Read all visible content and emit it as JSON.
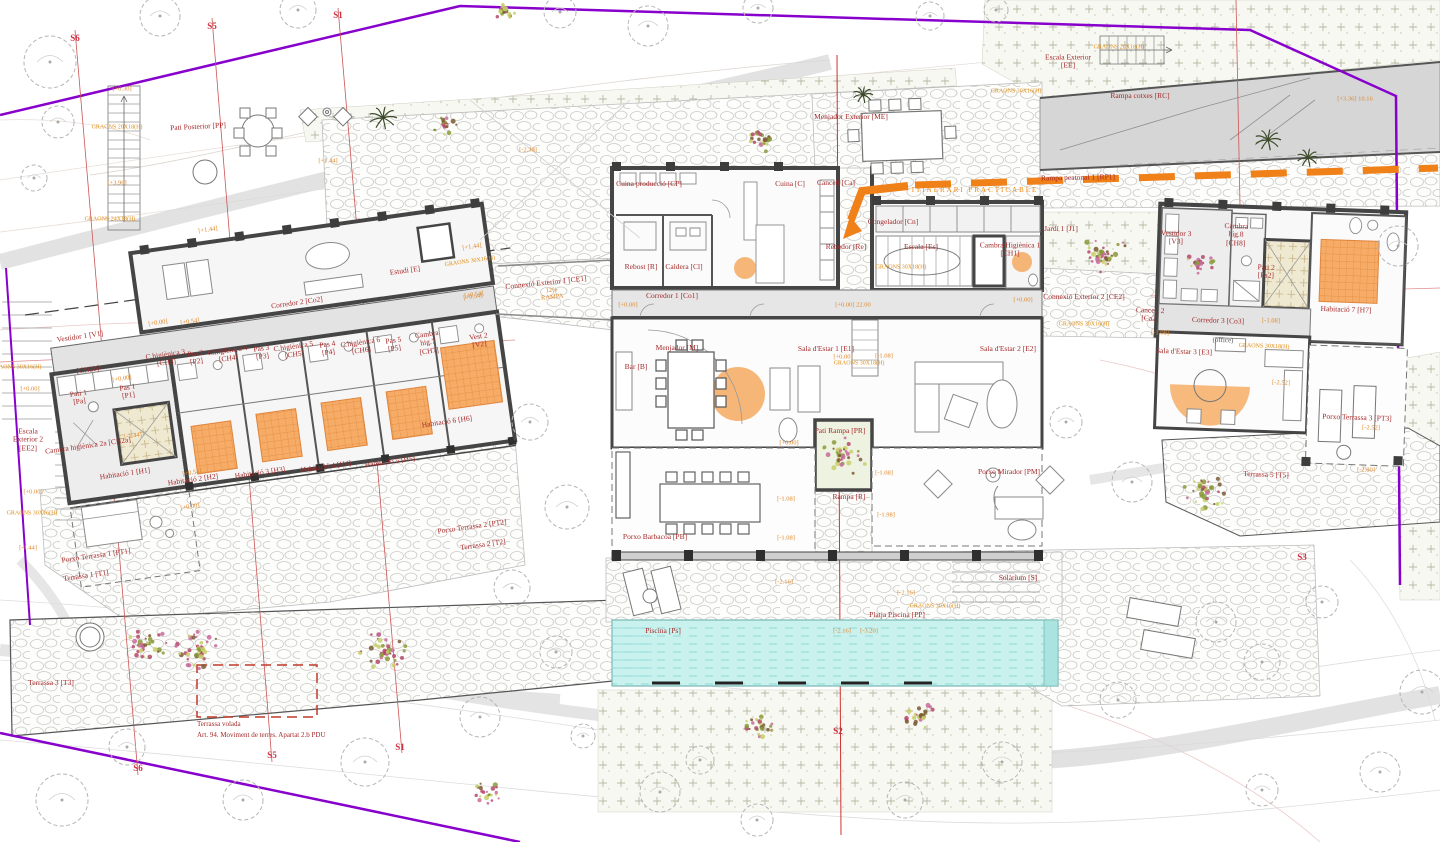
{
  "meta": {
    "title": "Planta distribució — habitatge unifamiliar (site plan)",
    "language": "ca"
  },
  "colors": {
    "room_label": "#a52a2a",
    "elevation_label": "#e0882a",
    "section_label": "#cf3344",
    "boundary_purple": "#8800cc",
    "driveway_orange": "#f08018",
    "bed_highlight": "#f5a95f",
    "pool_cyan": "#c9f2ef",
    "wall": "#454545"
  },
  "labels": [
    {
      "id": "vestidor-1",
      "t": "Vestidor 1 [V1]",
      "x": 80,
      "y": 337,
      "c": "room",
      "r": -8
    },
    {
      "id": "ch2b",
      "t": "[CH2b]",
      "x": 88,
      "y": 370,
      "c": "room",
      "r": -8
    },
    {
      "id": "pati-1",
      "t": "Pati 1\n[Pa]",
      "x": 79,
      "y": 398,
      "c": "room",
      "r": -8
    },
    {
      "id": "pas-1",
      "t": "Pas 1\n[P1]",
      "x": 128,
      "y": 392,
      "c": "room",
      "r": -8
    },
    {
      "id": "ch2a",
      "t": "Cambra higiènica 2a [CH2a]",
      "x": 88,
      "y": 446,
      "c": "room",
      "r": -8
    },
    {
      "id": "h1",
      "t": "Habitació 1 [H1]",
      "x": 125,
      "y": 474,
      "c": "room",
      "r": -8
    },
    {
      "id": "h2",
      "t": "Habitació 2 [H2]",
      "x": 193,
      "y": 480,
      "c": "room",
      "r": -8
    },
    {
      "id": "h3",
      "t": "Habitació 3 [H3]",
      "x": 260,
      "y": 473,
      "c": "room",
      "r": -8
    },
    {
      "id": "h4",
      "t": "Habitació 4 [H4]",
      "x": 326,
      "y": 467,
      "c": "room",
      "r": -8
    },
    {
      "id": "h5",
      "t": "Habitació 5 [H5]",
      "x": 390,
      "y": 462,
      "c": "room",
      "r": -8
    },
    {
      "id": "h6",
      "t": "Habitació 6 [H6]",
      "x": 447,
      "y": 422,
      "c": "room",
      "r": -8
    },
    {
      "id": "ch3",
      "t": "C.higiènica 3\n[CH3]",
      "x": 166,
      "y": 359,
      "c": "room",
      "r": -8
    },
    {
      "id": "pas-2",
      "t": "Pas 2\n[P2]",
      "x": 196,
      "y": 358,
      "c": "room",
      "r": -8
    },
    {
      "id": "ch4",
      "t": "C.higiènica 4\n[CH4]",
      "x": 228,
      "y": 355,
      "c": "room",
      "r": -8
    },
    {
      "id": "pas-3",
      "t": "Pas 3\n[P3]",
      "x": 262,
      "y": 353,
      "c": "room",
      "r": -8
    },
    {
      "id": "ch5",
      "t": "C.higiènica 5\n[CH5]",
      "x": 294,
      "y": 351,
      "c": "room",
      "r": -8
    },
    {
      "id": "pas-4",
      "t": "Pas 4\n[P4]",
      "x": 328,
      "y": 349,
      "c": "room",
      "r": -8
    },
    {
      "id": "ch6",
      "t": "C.higiènica 6\n[CH6]",
      "x": 361,
      "y": 347,
      "c": "room",
      "r": -8
    },
    {
      "id": "pas-5",
      "t": "Pas 5\n[P5]",
      "x": 394,
      "y": 345,
      "c": "room",
      "r": -8
    },
    {
      "id": "ch7",
      "t": "Cambra\nhig.7\n[CH7]",
      "x": 428,
      "y": 343,
      "c": "room",
      "r": -8
    },
    {
      "id": "vest-2",
      "t": "Vest 2\n[V2]",
      "x": 479,
      "y": 341,
      "c": "room",
      "r": -8
    },
    {
      "id": "corredor-2",
      "t": "Corredor 2 [Co2]",
      "x": 297,
      "y": 303,
      "c": "room",
      "r": -8
    },
    {
      "id": "estudi",
      "t": "Estudi [E]",
      "x": 405,
      "y": 271,
      "c": "room",
      "r": -8
    },
    {
      "id": "porxo-terrassa-1",
      "t": "Porxo Terrassa 1 [PT1]",
      "x": 96,
      "y": 556,
      "c": "room",
      "r": -8
    },
    {
      "id": "terrassa-1",
      "t": "Terrassa 1 [T1]",
      "x": 86,
      "y": 576,
      "c": "room",
      "r": -8
    },
    {
      "id": "porxo-terrassa-2",
      "t": "Porxo Terrassa 2 [PT2]",
      "x": 472,
      "y": 527,
      "c": "room",
      "r": -8
    },
    {
      "id": "terrassa-2",
      "t": "Terrassa 2 [T2]",
      "x": 483,
      "y": 545,
      "c": "room",
      "r": -8
    },
    {
      "id": "escala-exterior-2",
      "t": "Escala\nExterior 2\n[EE2]",
      "x": 28,
      "y": 440,
      "c": "room",
      "r": 0
    },
    {
      "id": "pati-posterior",
      "t": "Pati Posterior [PP]",
      "x": 198,
      "y": 127,
      "c": "room",
      "r": -3
    },
    {
      "id": "cuina-produccio",
      "t": "Cuina producció [CP]",
      "x": 649,
      "y": 184,
      "c": "room",
      "r": 0
    },
    {
      "id": "cuina",
      "t": "Cuina [C]",
      "x": 790,
      "y": 184,
      "c": "room",
      "r": 0
    },
    {
      "id": "cancell",
      "t": "Cancell [Ca]",
      "x": 836,
      "y": 183,
      "c": "room",
      "r": 0
    },
    {
      "id": "rebost",
      "t": "Rebost [R]",
      "x": 641,
      "y": 267,
      "c": "room",
      "r": 0
    },
    {
      "id": "caldera",
      "t": "Caldera [Cl]",
      "x": 684,
      "y": 267,
      "c": "room",
      "r": 0
    },
    {
      "id": "rebedor",
      "t": "Rebedor [Re]",
      "x": 846,
      "y": 247,
      "c": "room",
      "r": 0
    },
    {
      "id": "congelador",
      "t": "Congelador [Cn]",
      "x": 893,
      "y": 222,
      "c": "room",
      "r": 0
    },
    {
      "id": "escala",
      "t": "Escala [Es]",
      "x": 921,
      "y": 247,
      "c": "room",
      "r": 0
    },
    {
      "id": "ch1",
      "t": "Cambra Higiènica 1\n[CH1]",
      "x": 1010,
      "y": 250,
      "c": "room",
      "r": 0
    },
    {
      "id": "corredor-1",
      "t": "Corredor 1 [Co1]",
      "x": 672,
      "y": 296,
      "c": "room",
      "r": 0
    },
    {
      "id": "menjador",
      "t": "Menjador [M]",
      "x": 677,
      "y": 348,
      "c": "room",
      "r": 0
    },
    {
      "id": "bar",
      "t": "Bar [B]",
      "x": 636,
      "y": 367,
      "c": "room",
      "r": 0
    },
    {
      "id": "sala-estar-1",
      "t": "Sala d'Estar 1 [E1]",
      "x": 826,
      "y": 349,
      "c": "room",
      "r": 0
    },
    {
      "id": "sala-estar-2",
      "t": "Sala d'Estar 2 [E2]",
      "x": 1008,
      "y": 349,
      "c": "room",
      "r": 0
    },
    {
      "id": "pati-rampa",
      "t": "Pati Rampa [PR]",
      "x": 840,
      "y": 431,
      "c": "room",
      "r": 0
    },
    {
      "id": "rampa",
      "t": "Rampa [R]",
      "x": 849,
      "y": 497,
      "c": "room",
      "r": 0
    },
    {
      "id": "porxo-barbacoa",
      "t": "Porxo Barbacoa [PB]",
      "x": 655,
      "y": 537,
      "c": "room",
      "r": 0
    },
    {
      "id": "porxo-mirador",
      "t": "Porxo Mirador [PM]",
      "x": 1009,
      "y": 472,
      "c": "room",
      "r": 0
    },
    {
      "id": "solarium",
      "t": "Solàrium [S]",
      "x": 1018,
      "y": 578,
      "c": "room",
      "r": 0
    },
    {
      "id": "platja-piscina",
      "t": "Platja Piscina [PP]",
      "x": 897,
      "y": 615,
      "c": "room",
      "r": 0
    },
    {
      "id": "piscina",
      "t": "Piscina [Ps]",
      "x": 663,
      "y": 631,
      "c": "room",
      "r": 0
    },
    {
      "id": "vestidor-3",
      "t": "Vestidor 3\n[V3]",
      "x": 1176,
      "y": 238,
      "c": "room",
      "r": 2
    },
    {
      "id": "ch8",
      "t": "Cambra\nhig.8\n[CH8]",
      "x": 1236,
      "y": 235,
      "c": "room",
      "r": 2
    },
    {
      "id": "pati-2",
      "t": "Pati 2\n[Pa2]",
      "x": 1266,
      "y": 272,
      "c": "room",
      "r": 2
    },
    {
      "id": "h7",
      "t": "Habitació 7 [H7]",
      "x": 1346,
      "y": 310,
      "c": "room",
      "r": 2
    },
    {
      "id": "corredor-3",
      "t": "Corredor 3 [Co3]",
      "x": 1218,
      "y": 321,
      "c": "room",
      "r": 2
    },
    {
      "id": "cancell-2",
      "t": "Cancell 2\n[Ca2]",
      "x": 1150,
      "y": 315,
      "c": "room",
      "r": 2
    },
    {
      "id": "sala-estar-3",
      "t": "Sala d'Estar 3 [E3]",
      "x": 1184,
      "y": 352,
      "c": "room",
      "r": 2
    },
    {
      "id": "office",
      "t": "(office)",
      "x": 1223,
      "y": 341,
      "c": "dark",
      "r": 2
    },
    {
      "id": "porxo-terrassa-3",
      "t": "Porxo Terrassa 3 [PT3]",
      "x": 1357,
      "y": 418,
      "c": "room",
      "r": 2
    },
    {
      "id": "terrassa-5",
      "t": "Terrassa 5 [T5]",
      "x": 1266,
      "y": 475,
      "c": "room",
      "r": 2
    },
    {
      "id": "terrassa-3",
      "t": "Terrassa 3 [T3]",
      "x": 51,
      "y": 683,
      "c": "room",
      "r": 0
    },
    {
      "id": "jardi-1",
      "t": "Jardí 1 [J1]",
      "x": 1061,
      "y": 229,
      "c": "room",
      "r": 0
    },
    {
      "id": "connexio-1",
      "t": "Connexió Exterior 1 [CE1]",
      "x": 546,
      "y": 283,
      "c": "room",
      "r": -6
    },
    {
      "id": "connexio-2",
      "t": "Connexió Exterior 2 [CE2]",
      "x": 1084,
      "y": 297,
      "c": "room",
      "r": 0
    },
    {
      "id": "escala-exterior",
      "t": "Escala Exterior\n[EE]",
      "x": 1068,
      "y": 62,
      "c": "room",
      "r": 0
    },
    {
      "id": "rampa-cotxes",
      "t": "Rampa cotxes [RC]",
      "x": 1140,
      "y": 96,
      "c": "room",
      "r": 0
    },
    {
      "id": "rampa-peatonal",
      "t": "Rampa peatonal 1 [RP1]",
      "x": 1078,
      "y": 178,
      "c": "room",
      "r": -1
    },
    {
      "id": "menjador-exterior",
      "t": "Menjador Exterior [ME]",
      "x": 851,
      "y": 117,
      "c": "room",
      "r": 0
    },
    {
      "id": "terrassa-volada-1",
      "t": "Terrassa volada",
      "x": 197,
      "y": 725,
      "c": "note",
      "r": 0
    },
    {
      "id": "terrassa-volada-2",
      "t": "Art. 94. Moviment de terres. Apartat 2.b PDU",
      "x": 197,
      "y": 736,
      "c": "note",
      "r": 0
    },
    {
      "id": "e-a1",
      "t": "[+0.00]",
      "x": 158,
      "y": 323,
      "c": "elev",
      "r": -8
    },
    {
      "id": "e-a2",
      "t": "[+0.54]",
      "x": 190,
      "y": 322,
      "c": "elev",
      "r": -8
    },
    {
      "id": "e-a3",
      "t": "[+0.54]",
      "x": 474,
      "y": 295,
      "c": "elev",
      "r": -8
    },
    {
      "id": "e-a4",
      "t": "[+0.00]",
      "x": 122,
      "y": 379,
      "c": "elev",
      "r": -8
    },
    {
      "id": "e-a5",
      "t": "[-1.44]",
      "x": 133,
      "y": 436,
      "c": "elev",
      "r": -8
    },
    {
      "id": "e-a6",
      "t": "[+0.54]",
      "x": 192,
      "y": 473,
      "c": "elev",
      "r": -8
    },
    {
      "id": "e-a7",
      "t": "[+0.00]",
      "x": 190,
      "y": 507,
      "c": "elev",
      "r": -8
    },
    {
      "id": "e-a8",
      "t": "[+0.00]",
      "x": 30,
      "y": 389,
      "c": "elev",
      "r": 0
    },
    {
      "id": "e-a9",
      "t": "[+0.00]",
      "x": 33,
      "y": 492,
      "c": "elev",
      "r": 0
    },
    {
      "id": "e-a10",
      "t": "[-1.44]",
      "x": 28,
      "y": 548,
      "c": "elev",
      "r": 0
    },
    {
      "id": "e-b1",
      "t": "[+6.30]",
      "x": 122,
      "y": 89,
      "c": "elev",
      "r": 0
    },
    {
      "id": "e-b2",
      "t": "[+3.96]",
      "x": 117,
      "y": 183,
      "c": "elev",
      "r": 0
    },
    {
      "id": "e-b3",
      "t": "[+1.44]",
      "x": 328,
      "y": 161,
      "c": "elev",
      "r": 0
    },
    {
      "id": "e-b4",
      "t": "[+1.44]",
      "x": 208,
      "y": 230,
      "c": "elev",
      "r": -8
    },
    {
      "id": "e-b5",
      "t": "[+1.44]",
      "x": 472,
      "y": 247,
      "c": "elev",
      "r": -8
    },
    {
      "id": "e-b6",
      "t": "[+0.54]",
      "x": 473,
      "y": 297,
      "c": "elev",
      "r": -8
    },
    {
      "id": "e-b7",
      "t": "[-2.30]",
      "x": 528,
      "y": 150,
      "c": "elev",
      "r": 0
    },
    {
      "id": "e-c1",
      "t": "[+0.00]",
      "x": 628,
      "y": 305,
      "c": "elev",
      "r": 0
    },
    {
      "id": "e-c2",
      "t": "[+0.00] 22.00",
      "x": 853,
      "y": 305,
      "c": "elev",
      "r": 0
    },
    {
      "id": "e-c3",
      "t": "[+0.00]",
      "x": 1023,
      "y": 300,
      "c": "elev",
      "r": 0
    },
    {
      "id": "e-c4",
      "t": "12 %",
      "x": 890,
      "y": 190,
      "c": "elev",
      "r": 0
    },
    {
      "id": "e-c5",
      "t": "[+3.36] 10.16",
      "x": 1355,
      "y": 99,
      "c": "elev",
      "r": 0
    },
    {
      "id": "e-c6",
      "t": "[+0.00]",
      "x": 843,
      "y": 357,
      "c": "elev",
      "r": 0
    },
    {
      "id": "e-c7",
      "t": "[-1.08]",
      "x": 884,
      "y": 356,
      "c": "elev",
      "r": 0
    },
    {
      "id": "e-c8",
      "t": "[-1.08]",
      "x": 884,
      "y": 473,
      "c": "elev",
      "r": 0
    },
    {
      "id": "e-c9",
      "t": "[-1.98]",
      "x": 886,
      "y": 515,
      "c": "elev",
      "r": 0
    },
    {
      "id": "e-c10",
      "t": "[-1.08]",
      "x": 786,
      "y": 499,
      "c": "elev",
      "r": 0
    },
    {
      "id": "e-c11",
      "t": "[-1.08]",
      "x": 786,
      "y": 538,
      "c": "elev",
      "r": 0
    },
    {
      "id": "e-c12",
      "t": "[+0.00]",
      "x": 789,
      "y": 443,
      "c": "elev",
      "r": 0
    },
    {
      "id": "e-c13",
      "t": "[-2.16]",
      "x": 784,
      "y": 582,
      "c": "elev",
      "r": 0
    },
    {
      "id": "e-c14",
      "t": "[-2.16]",
      "x": 842,
      "y": 631,
      "c": "elev",
      "r": 0
    },
    {
      "id": "e-c15",
      "t": "[-3.20]",
      "x": 869,
      "y": 631,
      "c": "elev",
      "r": 0
    },
    {
      "id": "e-c16",
      "t": "[-2.16]",
      "x": 906,
      "y": 593,
      "c": "elev",
      "r": 0
    },
    {
      "id": "e-d1",
      "t": "[-2.52]",
      "x": 1281,
      "y": 383,
      "c": "elev",
      "r": 2
    },
    {
      "id": "e-d2",
      "t": "[-2.52]",
      "x": 1371,
      "y": 428,
      "c": "elev",
      "r": 2
    },
    {
      "id": "e-d3",
      "t": "[-1.08]",
      "x": 1271,
      "y": 321,
      "c": "elev",
      "r": 2
    },
    {
      "id": "e-d4",
      "t": "[-1.08]",
      "x": 1160,
      "y": 333,
      "c": "elev",
      "r": 2
    },
    {
      "id": "e-d5",
      "t": "[-2.80]",
      "x": 1366,
      "y": 470,
      "c": "elev",
      "r": 0
    },
    {
      "id": "e-ce1",
      "t": "12%\nRAMPA",
      "x": 552,
      "y": 294,
      "c": "elev",
      "r": -6
    },
    {
      "id": "g1",
      "t": "GRAONS 20X18(H)",
      "x": 117,
      "y": 128,
      "c": "graons",
      "r": 0
    },
    {
      "id": "g2",
      "t": "GRAONS 24X18(H)",
      "x": 110,
      "y": 220,
      "c": "graons",
      "r": 0
    },
    {
      "id": "g3",
      "t": "GRAONS 30X16(H)",
      "x": 16,
      "y": 368,
      "c": "graons",
      "r": 0
    },
    {
      "id": "g4",
      "t": "GRAONS 30X16(H)",
      "x": 32,
      "y": 514,
      "c": "graons",
      "r": 0
    },
    {
      "id": "g5",
      "t": "GRAONS 30X16(H)",
      "x": 470,
      "y": 262,
      "c": "graons",
      "r": -8
    },
    {
      "id": "g6",
      "t": "GRAONS 30X18(H)",
      "x": 901,
      "y": 268,
      "c": "graons",
      "r": 0
    },
    {
      "id": "g7",
      "t": "GRAONS 30X18(H)",
      "x": 859,
      "y": 364,
      "c": "graons",
      "r": 0
    },
    {
      "id": "g8",
      "t": "GRAONS 30X18(H)",
      "x": 1264,
      "y": 347,
      "c": "graons",
      "r": 2
    },
    {
      "id": "g9",
      "t": "GRAONS 30X16(H)",
      "x": 935,
      "y": 607,
      "c": "graons",
      "r": 0
    },
    {
      "id": "g10",
      "t": "GRAONS 30X16(H)",
      "x": 1084,
      "y": 325,
      "c": "graons",
      "r": 0
    },
    {
      "id": "g11",
      "t": "GRAONS 30X16(H)",
      "x": 1016,
      "y": 92,
      "c": "graons",
      "r": 0
    },
    {
      "id": "g12",
      "t": "GRAONS 20X18(H)",
      "x": 1119,
      "y": 48,
      "c": "graons",
      "r": 0
    },
    {
      "id": "itinerari",
      "t": "ITINERARI PRACTICABLE",
      "x": 975,
      "y": 191,
      "c": "itiner",
      "r": 0
    },
    {
      "id": "s6-top",
      "t": "S6",
      "x": 75,
      "y": 38,
      "c": "section",
      "r": 0
    },
    {
      "id": "s5-top",
      "t": "S5",
      "x": 212,
      "y": 26,
      "c": "section",
      "r": 0
    },
    {
      "id": "s1-top",
      "t": "S1",
      "x": 338,
      "y": 15,
      "c": "section",
      "r": 0
    },
    {
      "id": "s6-bottom",
      "t": "S6",
      "x": 138,
      "y": 768,
      "c": "section",
      "r": 0
    },
    {
      "id": "s5-bottom",
      "t": "S5",
      "x": 272,
      "y": 755,
      "c": "section",
      "r": 0
    },
    {
      "id": "s1-bottom",
      "t": "S1",
      "x": 400,
      "y": 747,
      "c": "section",
      "r": 0
    },
    {
      "id": "s2-bottom",
      "t": "S2",
      "x": 838,
      "y": 731,
      "c": "section",
      "r": 0
    },
    {
      "id": "s3-right",
      "t": "S3",
      "x": 1302,
      "y": 557,
      "c": "section",
      "r": 0
    }
  ],
  "site": {
    "trees": [
      [
        50,
        62,
        26
      ],
      [
        160,
        16,
        20
      ],
      [
        298,
        10,
        18
      ],
      [
        560,
        12,
        16
      ],
      [
        648,
        26,
        20
      ],
      [
        758,
        8,
        15
      ],
      [
        930,
        16,
        14
      ],
      [
        996,
        10,
        12
      ],
      [
        58,
        122,
        16
      ],
      [
        34,
        178,
        13
      ],
      [
        1398,
        246,
        20
      ],
      [
        530,
        422,
        18
      ],
      [
        567,
        507,
        22
      ],
      [
        512,
        588,
        18
      ],
      [
        556,
        652,
        16
      ],
      [
        480,
        717,
        20
      ],
      [
        365,
        762,
        24
      ],
      [
        243,
        800,
        20
      ],
      [
        62,
        800,
        26
      ],
      [
        127,
        747,
        18
      ],
      [
        660,
        792,
        20
      ],
      [
        757,
        820,
        16
      ],
      [
        905,
        800,
        18
      ],
      [
        1002,
        762,
        20
      ],
      [
        1118,
        700,
        18
      ],
      [
        1216,
        622,
        20
      ],
      [
        1322,
        602,
        16
      ],
      [
        1262,
        662,
        18
      ],
      [
        1422,
        692,
        22
      ],
      [
        1380,
        772,
        20
      ],
      [
        1262,
        790,
        16
      ],
      [
        1132,
        482,
        20
      ],
      [
        1066,
        422,
        16
      ],
      [
        700,
        760,
        14
      ],
      [
        583,
        736,
        12
      ]
    ],
    "flowers": [
      [
        765,
        140,
        16
      ],
      [
        445,
        126,
        12
      ],
      [
        1105,
        255,
        26
      ],
      [
        1200,
        262,
        14
      ],
      [
        843,
        456,
        24
      ],
      [
        762,
        727,
        17
      ],
      [
        921,
        716,
        16
      ],
      [
        487,
        793,
        14
      ],
      [
        200,
        650,
        26
      ],
      [
        385,
        652,
        26
      ],
      [
        148,
        643,
        20
      ],
      [
        1205,
        490,
        24
      ],
      [
        505,
        12,
        10
      ]
    ],
    "palms": [
      [
        383,
        118,
        14
      ],
      [
        1268,
        140,
        13
      ],
      [
        1308,
        158,
        11
      ],
      [
        863,
        95,
        10
      ]
    ]
  }
}
